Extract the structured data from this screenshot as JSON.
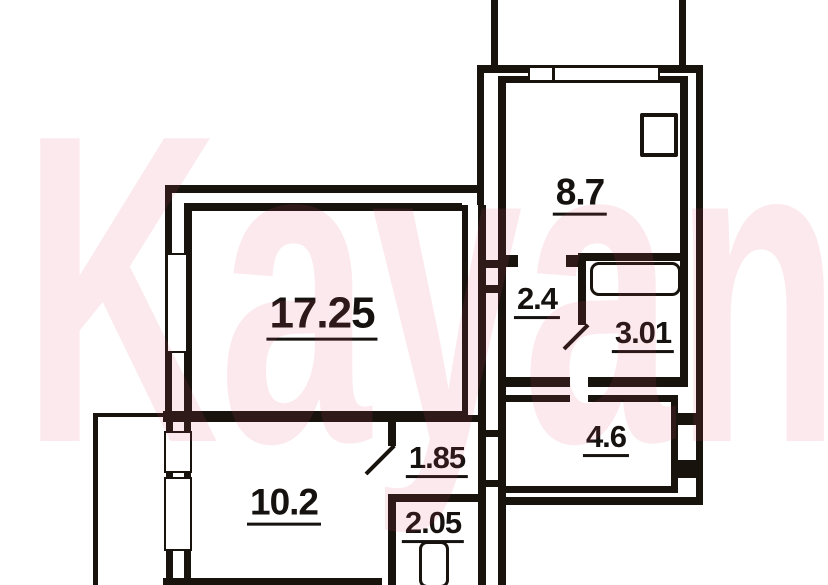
{
  "watermark": {
    "text": "Kayan",
    "color": "#de4669"
  },
  "palette": {
    "wall": "#19130e",
    "label": "#16120f",
    "background": "#ffffff"
  },
  "plan_title": "2-room apartment floor plan",
  "rooms": [
    {
      "id": "living-room",
      "label": "17.25"
    },
    {
      "id": "kitchen",
      "label": "8.7"
    },
    {
      "id": "hall",
      "label": "2.4"
    },
    {
      "id": "bathroom",
      "label": "3.01"
    },
    {
      "id": "corridor",
      "label": "4.6"
    },
    {
      "id": "closet",
      "label": "1.85"
    },
    {
      "id": "bedroom",
      "label": "10.2"
    },
    {
      "id": "wc",
      "label": "2.05"
    }
  ],
  "fixtures": [
    {
      "name": "bathtub"
    },
    {
      "name": "toilet"
    },
    {
      "name": "vent-shaft"
    }
  ],
  "windows": [
    {
      "name": "kitchen-window"
    },
    {
      "name": "living-room-window"
    },
    {
      "name": "bedroom-balcony-window-upper"
    },
    {
      "name": "bedroom-balcony-window-lower"
    }
  ],
  "doors": [
    {
      "name": "bathroom-door"
    },
    {
      "name": "bedroom-door"
    }
  ]
}
